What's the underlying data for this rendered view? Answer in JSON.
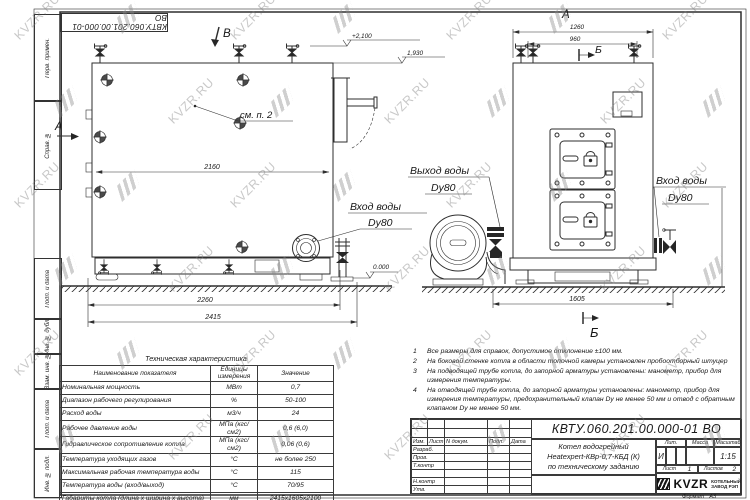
{
  "watermark": {
    "text": "KVZR.RU"
  },
  "frame": {
    "margin_fields": [
      "Перв. примен.",
      "Справ. №",
      "Подп. и дата",
      "Инв. № дубл.",
      "Взам. инв. №",
      "Подп. и дата",
      "Инв. № подл."
    ]
  },
  "views": {
    "left": {
      "section_b": "В",
      "section_a": "А",
      "elevation_top": "+2,100",
      "elevation_mid": "1,930",
      "elevation_zero": "0.000",
      "see_note": "см. п. 2",
      "dim_inner": "2160",
      "dim_base": "2260",
      "dim_total": "2415",
      "inlet_line1": "Вход воды",
      "inlet_line2": "Dy80"
    },
    "right": {
      "view_label": "А",
      "dim_width": "1260",
      "dim_inner": "960",
      "section_b_top": "Б",
      "section_b_bottom": "Б",
      "dim_base": "1605",
      "outlet_line1": "Выход воды",
      "outlet_line2": "Dy80",
      "inlet_line1": "Вход воды",
      "inlet_line2": "Dy80"
    }
  },
  "notes": [
    {
      "num": "1",
      "text": "Все размеры для справок, допустимое отклонение ±100 мм."
    },
    {
      "num": "2",
      "text": "На боковой стенке котла в области топочной камеры установлен пробоотборный штуцер"
    },
    {
      "num": "3",
      "text": "На подводящей трубе котла, до запорной арматуры установлены: манометр, прибор для измерения температуры."
    },
    {
      "num": "4",
      "text": "На отводящей трубе котла, до запорной арматуры установлены: манометр, прибор для измерения температуры, предохранительный клапан Dу не менее 50 мм и отвод с обратным клапаном Dу не менее 50 мм."
    }
  ],
  "spec_table": {
    "title": "Техническая характеристика",
    "headers": [
      "Наименование показателя",
      "Единицы измерения",
      "Значение"
    ],
    "rows": [
      {
        "name": "Номинальная мощность",
        "unit": "МВт",
        "value": "0,7"
      },
      {
        "name": "Диапазон рабочего регулирования",
        "unit": "%",
        "value": "50-100"
      },
      {
        "name": "Расход воды",
        "unit": "м3/ч",
        "value": "24"
      },
      {
        "name": "Рабочее давление воды",
        "unit": "МПа (кгс/см2)",
        "value": "0,6 (6,0)"
      },
      {
        "name": "Гидравлическое сопротивление котла",
        "unit": "МПа (кгс/см2)",
        "value": "0,06 (0,6)"
      },
      {
        "name": "Температура уходящих газов",
        "unit": "°С",
        "value": "не более 250"
      },
      {
        "name": "Максимальная рабочая температура воды",
        "unit": "°С",
        "value": "115"
      },
      {
        "name": "Температура воды (вход/выход)",
        "unit": "°С",
        "value": "70/95"
      },
      {
        "name": "Габариты котла (длина х ширина х высота)",
        "unit": "мм",
        "value": "2415х1605х2100"
      }
    ]
  },
  "title_block": {
    "doc_number": "КВТУ.060.201.00.000-01 ВО",
    "header_cols": [
      "Изм.",
      "Лист",
      "N докум.",
      "Подп.",
      "Дата"
    ],
    "row_labels": [
      "Разраб.",
      "Пров.",
      "Т.контр",
      "",
      "Н.контр",
      "Утв."
    ],
    "product_line1": "Котел водогрейный",
    "product_line2": "Heatexpert-КВр-0,7-КБД (К)",
    "product_line3": "по техническому заданию",
    "lit_label": "Лит.",
    "lit_value": "И",
    "mass_label": "Масса",
    "scale_label": "Масштаб",
    "scale_value": "1:15",
    "sheet_label": "Лист",
    "sheet_value": "1",
    "sheets_label": "Листов",
    "sheets_value": "2",
    "company_logo": "KVZR",
    "company_line1": "КОТЕЛЬНЫЙ",
    "company_line2": "ЗАВОД РЭП",
    "format_label": "Формат",
    "format_value": "А3"
  }
}
